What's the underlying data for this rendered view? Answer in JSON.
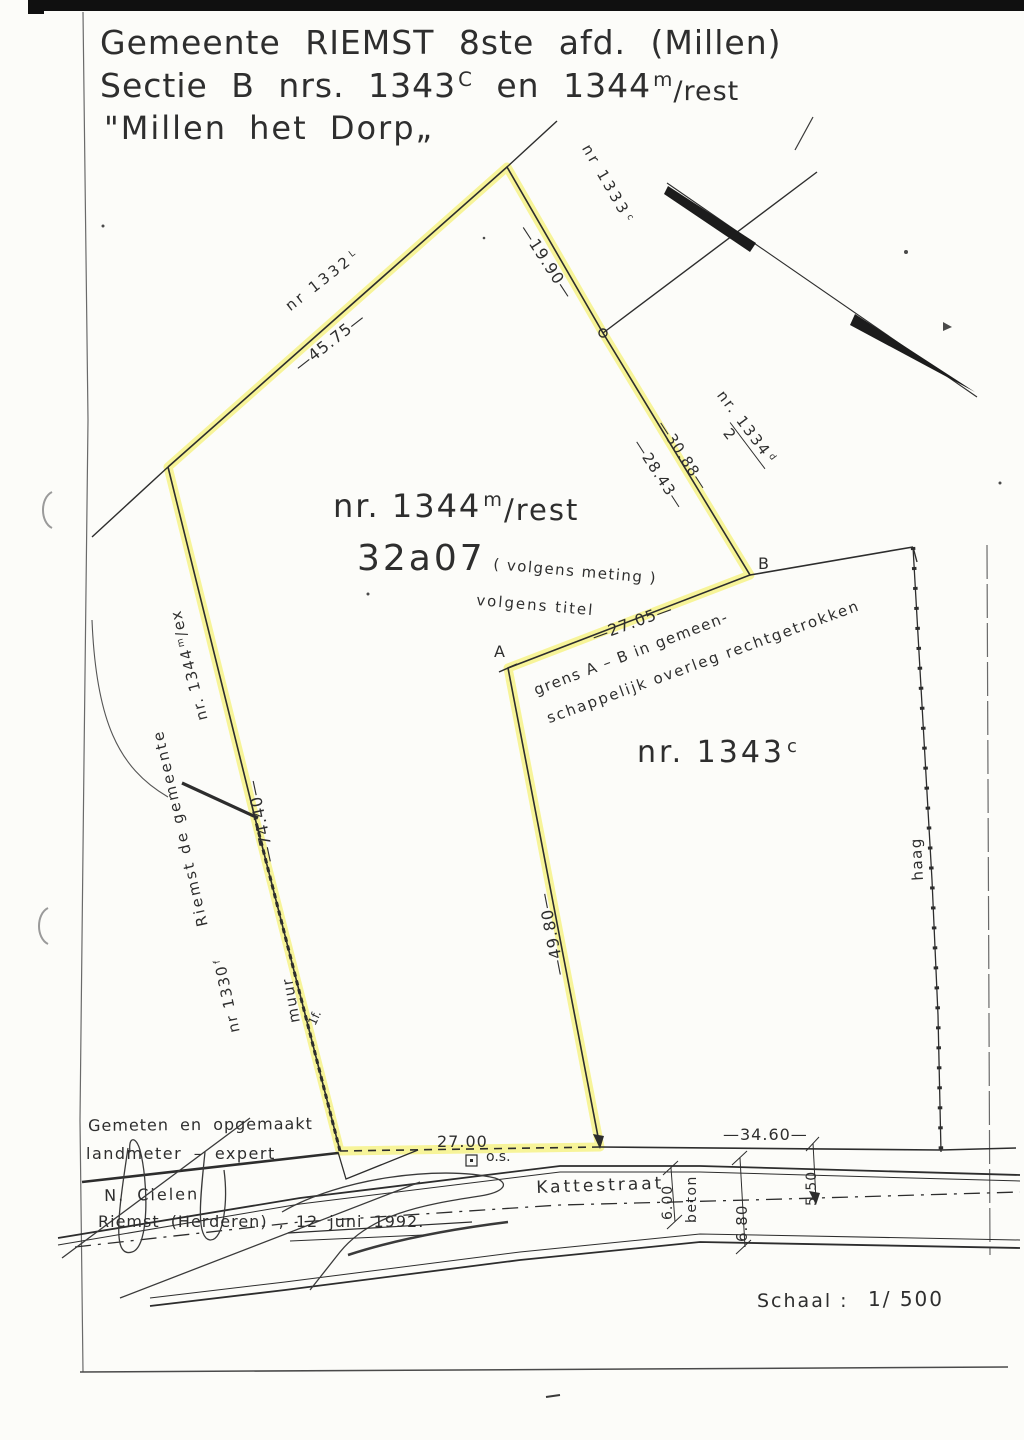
{
  "title": {
    "line1": "Gemeente RIEMST 8ste afd. (Millen)",
    "line2a": "Sectie B nrs. 1343",
    "line2sup1": "C",
    "line2b": "en 1344",
    "line2sup2": "m",
    "line2c": "/rest",
    "line3": "\"Millen het Dorp„"
  },
  "parcels": {
    "main": {
      "num": "nr. 1344",
      "sup": "m",
      "rest": "/rest",
      "area": "32a07",
      "meting": "( volgens meting )",
      "titel": "volgens titel"
    },
    "p1343": {
      "num": "nr. 1343",
      "sup": "c"
    },
    "n1332": {
      "num": "nr 1332",
      "sup": "L"
    },
    "n1333": {
      "num": "nr 1333",
      "sup": "c"
    },
    "n1334": {
      "num": "nr. 1334",
      "sup": "d",
      "denom": "2"
    },
    "n1330": {
      "num": "nr 1330",
      "sup": "f"
    },
    "n1344ex": {
      "num": "nr. 1344",
      "sup": "m",
      "rest": "/ex"
    }
  },
  "points": {
    "a": "A",
    "b": "B"
  },
  "measurements": {
    "m4575": "—45.75—",
    "m1990": "—19.90—",
    "m3088": "—30.88—",
    "m2843": "—28.43—",
    "m2705": "—27.05—",
    "m7440": "—74.40—",
    "m4980": "—49.80—",
    "m2700": "27.00",
    "m3460": "—34.60—",
    "m600": "6.00",
    "m680": "6.80",
    "m550": "5.50"
  },
  "notes": {
    "grens1": "grens A – B in gemeen-",
    "grens2": "schappelijk overleg rechtgetrokken",
    "riemst": "Riemst de gemeente",
    "muur": "muur",
    "haag": "haag",
    "beton": "beton",
    "os": "o.s.",
    "mark": "1f."
  },
  "street": {
    "name": "Kattestraat"
  },
  "footer": {
    "line1": "Gemeten en opgemaakt",
    "line2": "landmeter – expert",
    "name": "N. Cielen",
    "line3": "Riemst (Herderen) , 12 juni 1992.",
    "schaal_label": "Schaal :",
    "schaal_value": "1/ 500"
  },
  "colors": {
    "highlight": "#f3ef5d",
    "ink": "#2f2f2f"
  }
}
